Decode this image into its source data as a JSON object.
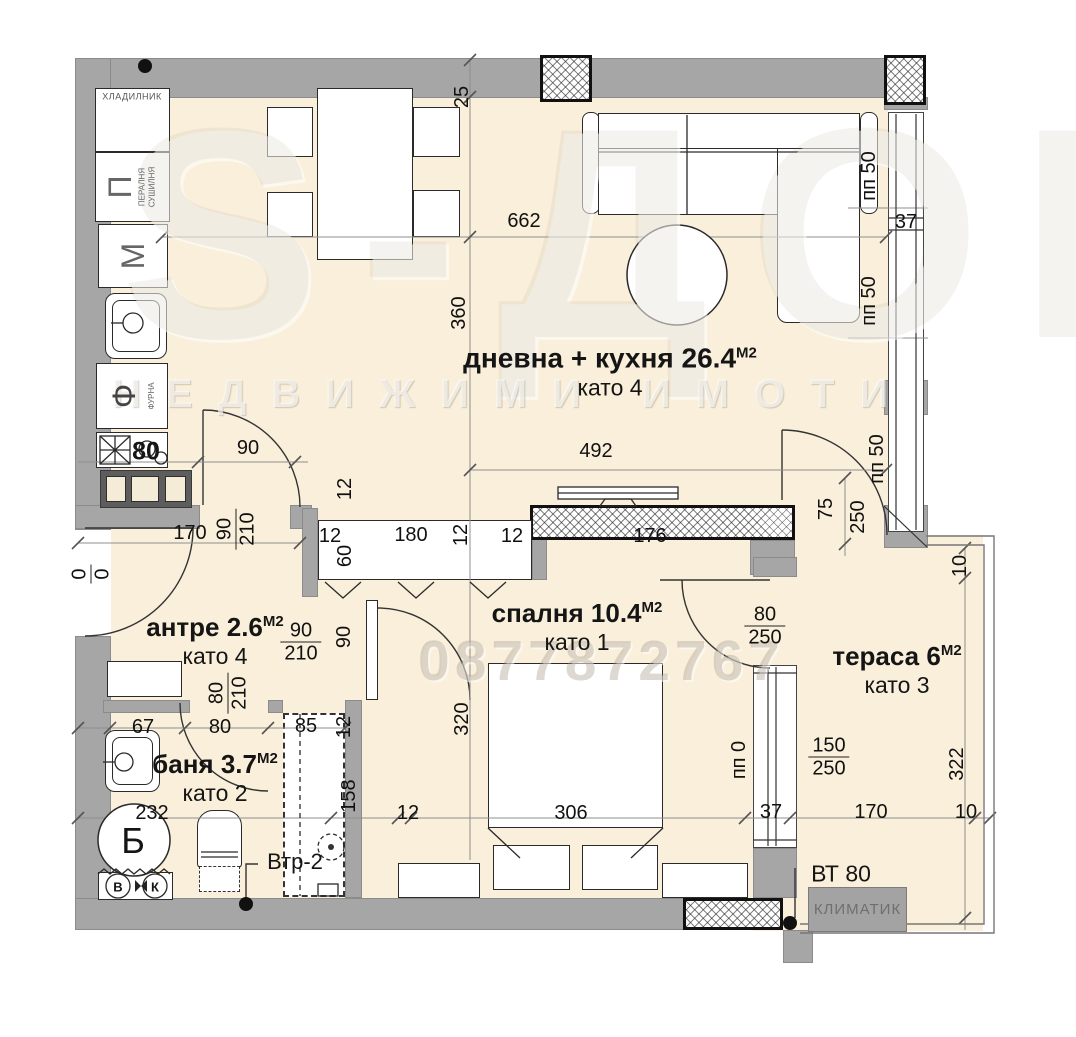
{
  "title": "Апартамент — разпределение (floor plan)",
  "plan": {
    "rooms": [
      {
        "name": "дневна + кухня",
        "area": "26.4",
        "unit": "М2",
        "kato": "като 4"
      },
      {
        "name": "спалня",
        "area": "10.4",
        "unit": "М2",
        "kato": "като 1"
      },
      {
        "name": "антре",
        "area": "2.6",
        "unit": "М2",
        "kato": "като 4"
      },
      {
        "name": "баня",
        "area": "3.7",
        "unit": "М2",
        "kato": "като 2"
      },
      {
        "name": "тераса",
        "area": "6",
        "unit": "М2",
        "kato": "като 3"
      }
    ]
  },
  "appliances": {
    "fridge": "ХЛАДИЛНИК",
    "washer_letter": "П",
    "washer_sub1": "ПЕРАЛНЯ",
    "washer_sub2": "СУШИЛНЯ",
    "m_letter": "М",
    "oven_letter": "Ф",
    "oven_sub": "ФУРНА",
    "stove_size": "80",
    "boiler_letter": "Б",
    "valve_b": "В",
    "valve_k": "К"
  },
  "annotations": {
    "vent": "Втр-2",
    "vt": "ВТ 80",
    "ac": "КЛИМАТИК"
  },
  "watermark": {
    "brand": "S-ДОМ",
    "line2": "НЕДВИЖИМИ ИМОТИ",
    "phone": "0877872767"
  },
  "colors": {
    "floor": "#f9efdb",
    "wall": "#a6a6a6",
    "cabinet_dark": "#5d5d5d",
    "ac_box": "#a3a3a3",
    "line": "#333333"
  },
  "dimensions": [
    {
      "t": "25",
      "x": 462,
      "y": 97,
      "r": -90
    },
    {
      "t": "662",
      "x": 524,
      "y": 221
    },
    {
      "t": "360",
      "x": 459,
      "y": 313,
      "r": -90
    },
    {
      "t": "492",
      "x": 596,
      "y": 451
    },
    {
      "t": "176",
      "x": 650,
      "y": 536
    },
    {
      "t": "пп 50",
      "x": 869,
      "y": 176,
      "r": -90
    },
    {
      "t": "37",
      "x": 906,
      "y": 222
    },
    {
      "t": "пп 50",
      "x": 869,
      "y": 301,
      "r": -90
    },
    {
      "t": "пп 50",
      "x": 877,
      "y": 459,
      "r": -90
    },
    {
      "t": "75",
      "x": 826,
      "y": 509,
      "r": -90
    },
    {
      "t": "250",
      "x": 858,
      "y": 517,
      "r": -90
    },
    {
      "t": "90",
      "x": 248,
      "y": 448
    },
    {
      "top": "90",
      "bot": "210",
      "x": 236,
      "y": 529,
      "r": -90
    },
    {
      "t": "170",
      "x": 190,
      "y": 533
    },
    {
      "top": "0",
      "bot": "0",
      "x": 91,
      "y": 574,
      "r": -90
    },
    {
      "t": "12",
      "x": 345,
      "y": 489,
      "r": -90
    },
    {
      "t": "12",
      "x": 330,
      "y": 536
    },
    {
      "t": "180",
      "x": 411,
      "y": 535
    },
    {
      "t": "12",
      "x": 461,
      "y": 535,
      "r": -90
    },
    {
      "t": "12",
      "x": 512,
      "y": 536
    },
    {
      "t": "60",
      "x": 345,
      "y": 556,
      "r": -90
    },
    {
      "top": "90",
      "bot": "210",
      "x": 301,
      "y": 642
    },
    {
      "t": "90",
      "x": 344,
      "y": 637,
      "r": -90
    },
    {
      "top": "80",
      "bot": "210",
      "x": 228,
      "y": 693,
      "r": -90
    },
    {
      "t": "80",
      "x": 220,
      "y": 727
    },
    {
      "t": "67",
      "x": 143,
      "y": 727
    },
    {
      "t": "85",
      "x": 306,
      "y": 726
    },
    {
      "t": "12",
      "x": 344,
      "y": 727,
      "r": -90
    },
    {
      "t": "232",
      "x": 152,
      "y": 813
    },
    {
      "t": "158",
      "x": 349,
      "y": 796,
      "r": -90
    },
    {
      "t": "320",
      "x": 462,
      "y": 719,
      "r": -90
    },
    {
      "t": "12",
      "x": 408,
      "y": 813
    },
    {
      "t": "306",
      "x": 571,
      "y": 813
    },
    {
      "top": "80",
      "bot": "250",
      "x": 765,
      "y": 626
    },
    {
      "top": "150",
      "bot": "250",
      "x": 829,
      "y": 757
    },
    {
      "t": "пп 0",
      "x": 739,
      "y": 760,
      "r": -90
    },
    {
      "t": "37",
      "x": 771,
      "y": 812
    },
    {
      "t": "170",
      "x": 871,
      "y": 812
    },
    {
      "t": "10",
      "x": 966,
      "y": 812
    },
    {
      "t": "322",
      "x": 957,
      "y": 764,
      "r": -90
    },
    {
      "t": "10",
      "x": 960,
      "y": 566,
      "r": -90
    }
  ]
}
